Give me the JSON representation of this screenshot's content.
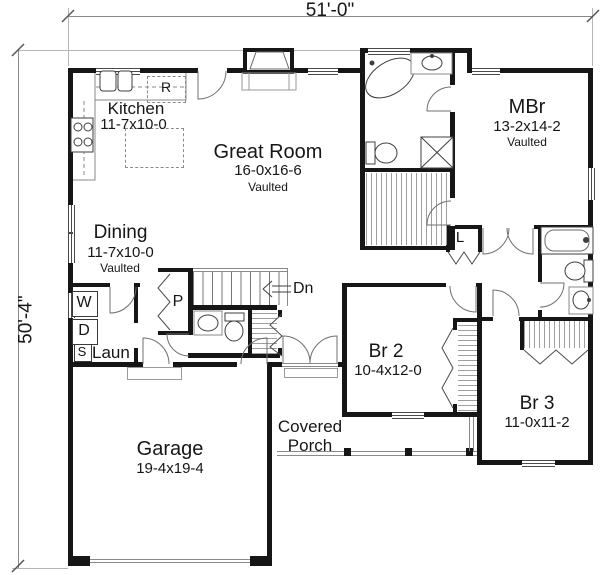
{
  "dim": {
    "width": "51'-0\"",
    "depth": "50'-4\""
  },
  "rooms": {
    "kitchen": {
      "name": "Kitchen",
      "size": "11-7x10-0"
    },
    "great": {
      "name": "Great Room",
      "size": "16-0x16-6",
      "note": "Vaulted"
    },
    "dining": {
      "name": "Dining",
      "size": "11-7x10-0",
      "note": "Vaulted"
    },
    "mbr": {
      "name": "MBr",
      "size": "13-2x14-2",
      "note": "Vaulted"
    },
    "br2": {
      "name": "Br 2",
      "size": "10-4x12-0"
    },
    "br3": {
      "name": "Br 3",
      "size": "11-0x11-2"
    },
    "garage": {
      "name": "Garage",
      "size": "19-4x19-4"
    },
    "porch": {
      "name": "Covered Porch"
    },
    "laundry": {
      "name": "Laun"
    }
  },
  "fixtures": {
    "washer": "W",
    "dryer": "D",
    "laundry_sink": "S",
    "pantry": "P",
    "refrigerator": "R",
    "linen": "L",
    "stairs_down": "Dn"
  },
  "colors": {
    "walls": "#161616",
    "thin_lines": "#8a8a8a",
    "background": "#ffffff",
    "text": "#161616"
  }
}
